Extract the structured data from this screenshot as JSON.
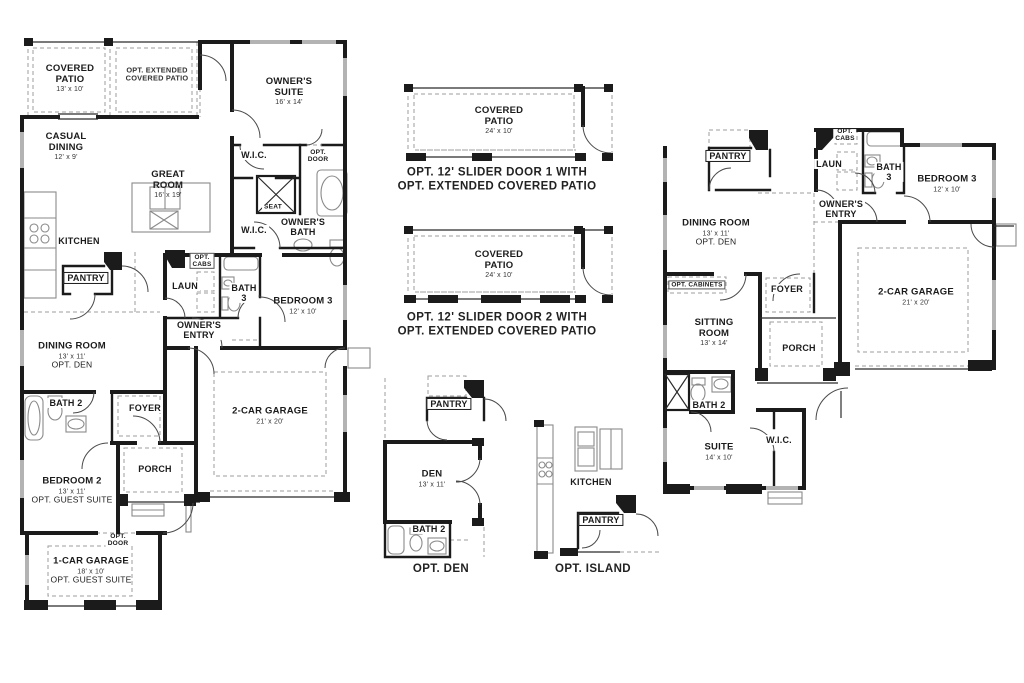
{
  "title": "Floor plan sheet with base plan, slider-door patio options, optional den, optional island and alternate plan",
  "colors": {
    "wall": "#1b1b1b",
    "optional_dashed": "#9c9c9c",
    "fixture": "#8a8a8a",
    "window": "#b3b3b3",
    "background": "#ffffff"
  },
  "plans": {
    "left_plan": {
      "labels": [
        {
          "x": 70,
          "y": 79,
          "name": "COVERED\nPATIO",
          "dims": "13' x 10'",
          "cls": "room"
        },
        {
          "x": 157,
          "y": 75,
          "name": "OPT. EXTENDED\nCOVERED PATIO",
          "cls": "opt"
        },
        {
          "x": 289,
          "y": 92,
          "name": "OWNER'S\nSUITE",
          "dims": "16' x 14'",
          "cls": "room"
        },
        {
          "x": 66,
          "y": 147,
          "name": "CASUAL\nDINING",
          "dims": "12' x 9'",
          "cls": "room"
        },
        {
          "x": 168,
          "y": 185,
          "name": "GREAT\nROOM",
          "dims": "16' x 19'",
          "cls": "room"
        },
        {
          "x": 254,
          "y": 155,
          "name": "W.I.C.",
          "cls": "small bg"
        },
        {
          "x": 318,
          "y": 157,
          "name": "OPT.\nDOOR",
          "cls": "tiny bg"
        },
        {
          "x": 273,
          "y": 208,
          "name": "SEAT",
          "cls": "tiny bg"
        },
        {
          "x": 254,
          "y": 230,
          "name": "W.I.C.",
          "cls": "small bg"
        },
        {
          "x": 303,
          "y": 227,
          "name": "OWNER'S\nBATH",
          "cls": "small bg"
        },
        {
          "x": 79,
          "y": 241,
          "name": "KITCHEN",
          "cls": "small"
        },
        {
          "x": 86,
          "y": 278,
          "name": "PANTRY",
          "cls": "boxed"
        },
        {
          "x": 202,
          "y": 261,
          "name": "OPT.\nCABS",
          "cls": "boxedtiny bg"
        },
        {
          "x": 185,
          "y": 286,
          "name": "LAUN",
          "cls": "small bg"
        },
        {
          "x": 244,
          "y": 293,
          "name": "BATH\n3",
          "cls": "small bg"
        },
        {
          "x": 303,
          "y": 306,
          "name": "BEDROOM 3",
          "dims": "12' x 10'",
          "cls": "room"
        },
        {
          "x": 199,
          "y": 330,
          "name": "OWNER'S\nENTRY",
          "cls": "small bg"
        },
        {
          "x": 72,
          "y": 356,
          "name": "DINING ROOM",
          "dims": "13' x 11'",
          "note": "OPT. DEN",
          "cls": "room"
        },
        {
          "x": 66,
          "y": 403,
          "name": "BATH 2",
          "cls": "small bg"
        },
        {
          "x": 145,
          "y": 408,
          "name": "FOYER",
          "cls": "small bg"
        },
        {
          "x": 270,
          "y": 416,
          "name": "2-CAR GARAGE",
          "dims": "21' x 20'",
          "cls": "room"
        },
        {
          "x": 155,
          "y": 469,
          "name": "PORCH",
          "cls": "small"
        },
        {
          "x": 72,
          "y": 491,
          "name": "BEDROOM 2",
          "dims": "13' x 11'",
          "note": "OPT. GUEST SUITE",
          "cls": "room"
        },
        {
          "x": 118,
          "y": 541,
          "name": "OPT.\nDOOR",
          "cls": "tiny bg"
        },
        {
          "x": 91,
          "y": 571,
          "name": "1-CAR GARAGE",
          "dims": "18' x 10'",
          "note": "OPT. GUEST SUITE",
          "cls": "room"
        }
      ]
    },
    "patio_options": {
      "labels": [
        {
          "x": 499,
          "y": 121,
          "name": "COVERED\nPATIO",
          "dims": "24' x 10'",
          "cls": "room"
        },
        {
          "x": 497,
          "y": 180,
          "name": "OPT. 12' SLIDER DOOR 1 WITH\nOPT. EXTENDED COVERED PATIO",
          "cls": "caption"
        },
        {
          "x": 499,
          "y": 265,
          "name": "COVERED\nPATIO",
          "dims": "24' x 10'",
          "cls": "room"
        },
        {
          "x": 497,
          "y": 325,
          "name": "OPT. 12' SLIDER DOOR 2 WITH\nOPT. EXTENDED COVERED PATIO",
          "cls": "caption"
        }
      ]
    },
    "opt_den": {
      "labels": [
        {
          "x": 449,
          "y": 404,
          "name": "PANTRY",
          "cls": "boxed"
        },
        {
          "x": 432,
          "y": 479,
          "name": "DEN",
          "dims": "13' x 11'",
          "cls": "room"
        },
        {
          "x": 429,
          "y": 529,
          "name": "BATH 2",
          "cls": "small bg"
        },
        {
          "x": 441,
          "y": 569,
          "name": "OPT. DEN",
          "cls": "caption"
        }
      ]
    },
    "opt_island": {
      "labels": [
        {
          "x": 591,
          "y": 482,
          "name": "KITCHEN",
          "cls": "small"
        },
        {
          "x": 601,
          "y": 520,
          "name": "PANTRY",
          "cls": "boxed"
        },
        {
          "x": 593,
          "y": 569,
          "name": "OPT. ISLAND",
          "cls": "caption"
        }
      ]
    },
    "right_plan": {
      "labels": [
        {
          "x": 728,
          "y": 156,
          "name": "PANTRY",
          "cls": "boxed"
        },
        {
          "x": 845,
          "y": 136,
          "name": "OPT.\nCABS",
          "cls": "tiny bg"
        },
        {
          "x": 829,
          "y": 164,
          "name": "LAUN",
          "cls": "small bg"
        },
        {
          "x": 889,
          "y": 172,
          "name": "BATH\n3",
          "cls": "small bg"
        },
        {
          "x": 947,
          "y": 184,
          "name": "BEDROOM 3",
          "dims": "12' x 10'",
          "cls": "room"
        },
        {
          "x": 841,
          "y": 209,
          "name": "OWNER'S\nENTRY",
          "cls": "small bg"
        },
        {
          "x": 716,
          "y": 233,
          "name": "DINING ROOM",
          "dims": "13' x 11'",
          "note": "OPT. DEN",
          "cls": "room"
        },
        {
          "x": 697,
          "y": 285,
          "name": "OPT. CABINETS",
          "cls": "boxedtiny"
        },
        {
          "x": 787,
          "y": 289,
          "name": "FOYER",
          "cls": "small bg"
        },
        {
          "x": 916,
          "y": 297,
          "name": "2-CAR GARAGE",
          "dims": "21' x 20'",
          "cls": "room"
        },
        {
          "x": 714,
          "y": 333,
          "name": "SITTING\nROOM",
          "dims": "13' x 14'",
          "cls": "room"
        },
        {
          "x": 799,
          "y": 348,
          "name": "PORCH",
          "cls": "small"
        },
        {
          "x": 709,
          "y": 405,
          "name": "BATH 2",
          "cls": "small bg"
        },
        {
          "x": 719,
          "y": 452,
          "name": "SUITE",
          "dims": "14' x 10'",
          "cls": "room"
        },
        {
          "x": 779,
          "y": 440,
          "name": "W.I.C.",
          "cls": "small bg"
        }
      ]
    }
  }
}
